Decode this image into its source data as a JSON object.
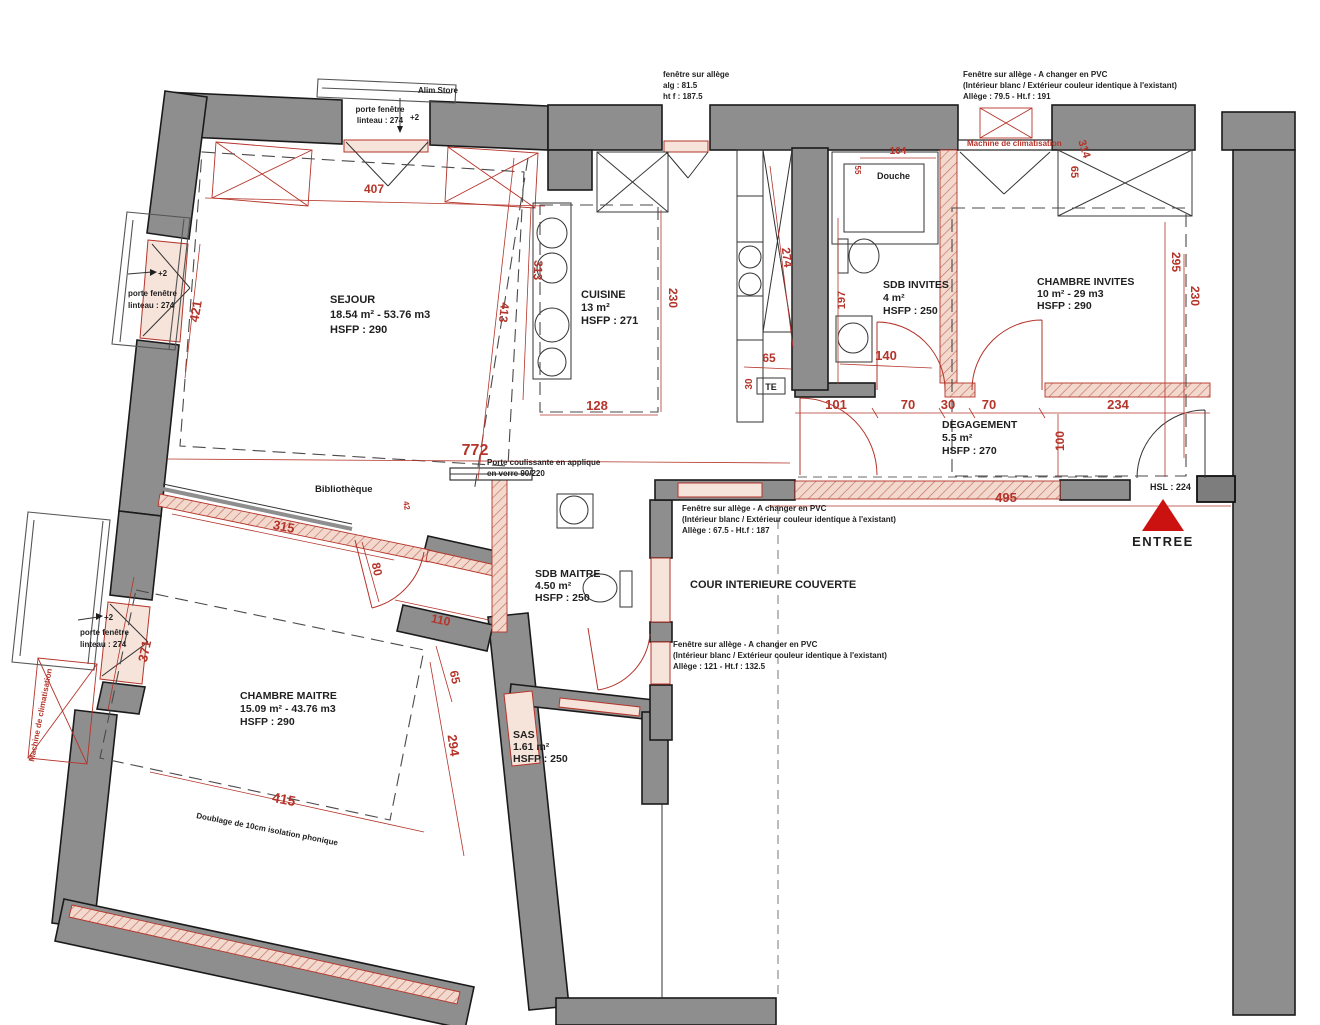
{
  "plan": {
    "rooms": {
      "sejour": {
        "name": "SEJOUR",
        "area": "18.54 m² - 53.76 m3",
        "hsfp": "HSFP : 290"
      },
      "cuisine": {
        "name": "CUISINE",
        "area": "13 m²",
        "hsfp": "HSFP : 271"
      },
      "sdb_invites": {
        "name": "SDB INVITES",
        "area": "4 m²",
        "hsfp": "HSFP : 250"
      },
      "chambre_invites": {
        "name": "CHAMBRE INVITES",
        "area": "10 m² - 29 m3",
        "hsfp": "HSFP : 290"
      },
      "degagement": {
        "name": "DEGAGEMENT",
        "area": "5.5 m²",
        "hsfp": "HSFP : 270"
      },
      "sdb_maitre": {
        "name": "SDB MAITRE",
        "area": "4.50 m²",
        "hsfp": "HSFP : 250"
      },
      "chambre_maitre": {
        "name": "CHAMBRE MAITRE",
        "area": "15.09 m² - 43.76 m3",
        "hsfp": "HSFP : 290"
      },
      "sas": {
        "name": "SAS",
        "area": "1.61 m²",
        "hsfp": "HSFP : 250"
      },
      "cour": {
        "name": "COUR INTERIEURE COUVERTE"
      },
      "douche": {
        "name": "Douche"
      },
      "bibliotheque": {
        "name": "Bibliothèque"
      }
    },
    "entry": {
      "label": "ENTREE",
      "hsl": "HSL : 224"
    },
    "notes": {
      "alim_store": "Alim Store",
      "plus2": "+2",
      "porte_fenetre": {
        "l1": "porte fenêtre",
        "l2": "linteau : 274"
      },
      "fenetre_allege_top": {
        "l1": "fenêtre sur allège",
        "l2": "alg : 81.5",
        "l3": "ht f : 187.5"
      },
      "fenetre_pvc": {
        "l1": "Fenêtre sur allège - A changer en PVC",
        "l2": "(Intérieur blanc / Extérieur couleur identique à l'existant)"
      },
      "allege_top": "Allège : 79.5 - Ht.f : 191",
      "allege_mid": "Allège : 67.5 - Ht.f : 187",
      "allege_bottom": "Allège : 121 - Ht.f : 132.5",
      "machine_clim": "Machine de climatisation",
      "porte_coulissante": {
        "l1": "Porte coulissante en applique",
        "l2": "en verre 90/220"
      },
      "doublage": "Doublage de 10cm isolation phonique",
      "te": "TE"
    },
    "dims": {
      "d407": "407",
      "d421": "421",
      "d313": "313",
      "d413": "413",
      "d230_cuisine": "230",
      "d128": "128",
      "d274": "274",
      "d65_cuisine": "65",
      "d30_te": "30",
      "d55": "55",
      "d104": "104",
      "d197": "197",
      "d140": "140",
      "d101": "101",
      "d70a": "70",
      "d30_mid": "30",
      "d70b": "70",
      "d234": "234",
      "d100": "100",
      "d295": "295",
      "d230_invites": "230",
      "d314": "314",
      "d65_invites": "65",
      "d772": "772",
      "d495": "495",
      "d42": "42",
      "d315": "315",
      "d80": "80",
      "d371": "371",
      "d110": "110",
      "d65_maitre": "65",
      "d294": "294",
      "d415": "415"
    },
    "colors": {
      "wall": "#8e8e8e",
      "dim": "#b5342a",
      "entry_arrow": "#cc1111"
    }
  }
}
